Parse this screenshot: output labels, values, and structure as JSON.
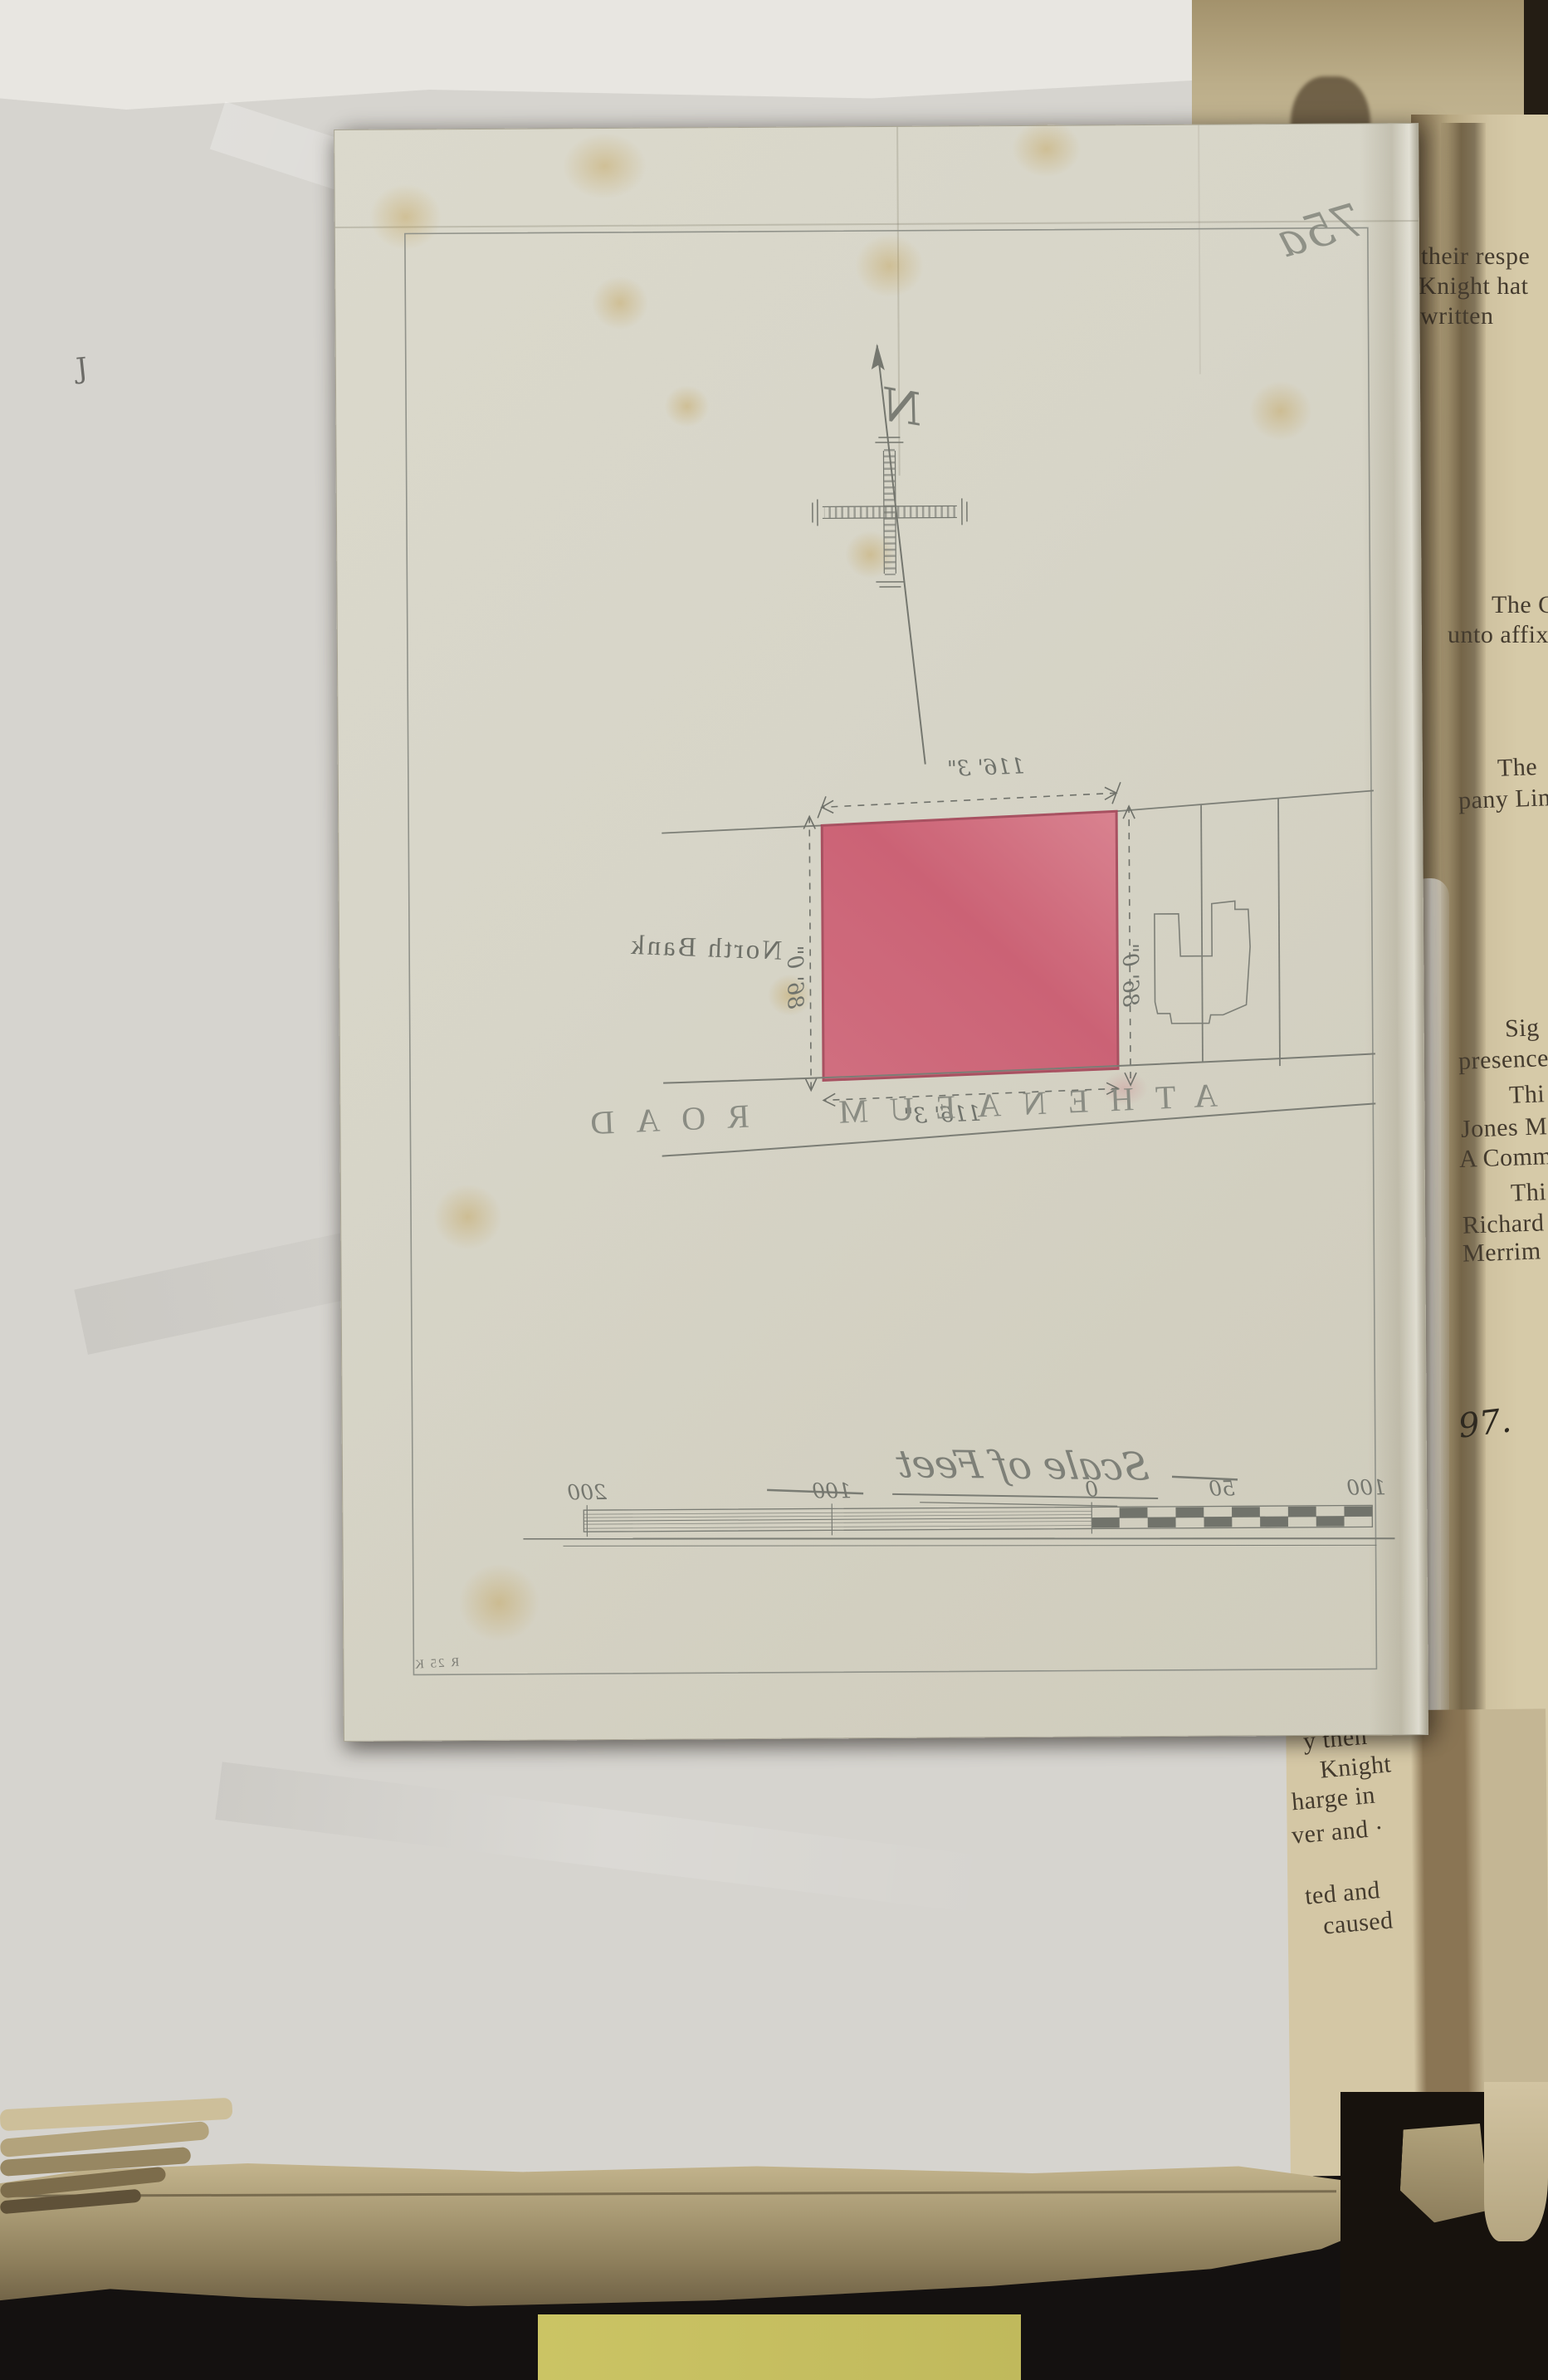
{
  "plan": {
    "sheet_number": "75a",
    "compass_letter": "N",
    "labels": {
      "north_bank": "North Bank",
      "road": "ATHENAEUM ROAD"
    },
    "dimensions": {
      "front": "116' 3\"",
      "rear": "116' 3\"",
      "east_side": "86' 0\"",
      "west_side": "86' 0\""
    },
    "scale": {
      "title": "Scale of Feet",
      "ticks": [
        "100",
        "50",
        "0",
        "100",
        "200"
      ]
    },
    "corner_inscription": "R 25 K"
  },
  "book_page": {
    "top_fragment": [
      "their respe",
      "Knight hat",
      "written"
    ],
    "seal_fragment": [
      "The C",
      "unto affix"
    ],
    "company_fragment": [
      "The",
      "pany Lim"
    ],
    "attestation_fragment": [
      "Sig",
      "presence",
      "Thi",
      "Jones M",
      "A Comm",
      "Thi",
      "Richard",
      "Merrim"
    ],
    "folio_number": "97.",
    "bottom_fragment": [
      "y then",
      "Knight",
      "harge in",
      "ver and ·",
      "ted and",
      "caused"
    ]
  },
  "left_page_mark": "J",
  "colors": {
    "parcel_fill": "#cf6176",
    "parcel_outline": "#a64a5c",
    "pencil": "#75776f",
    "page_cream": "#d5c8a6",
    "tracing_paper": "#d8d6c9",
    "note_yellow": "#cbc464",
    "ink_text": "#443b2e",
    "background": "#141110"
  }
}
